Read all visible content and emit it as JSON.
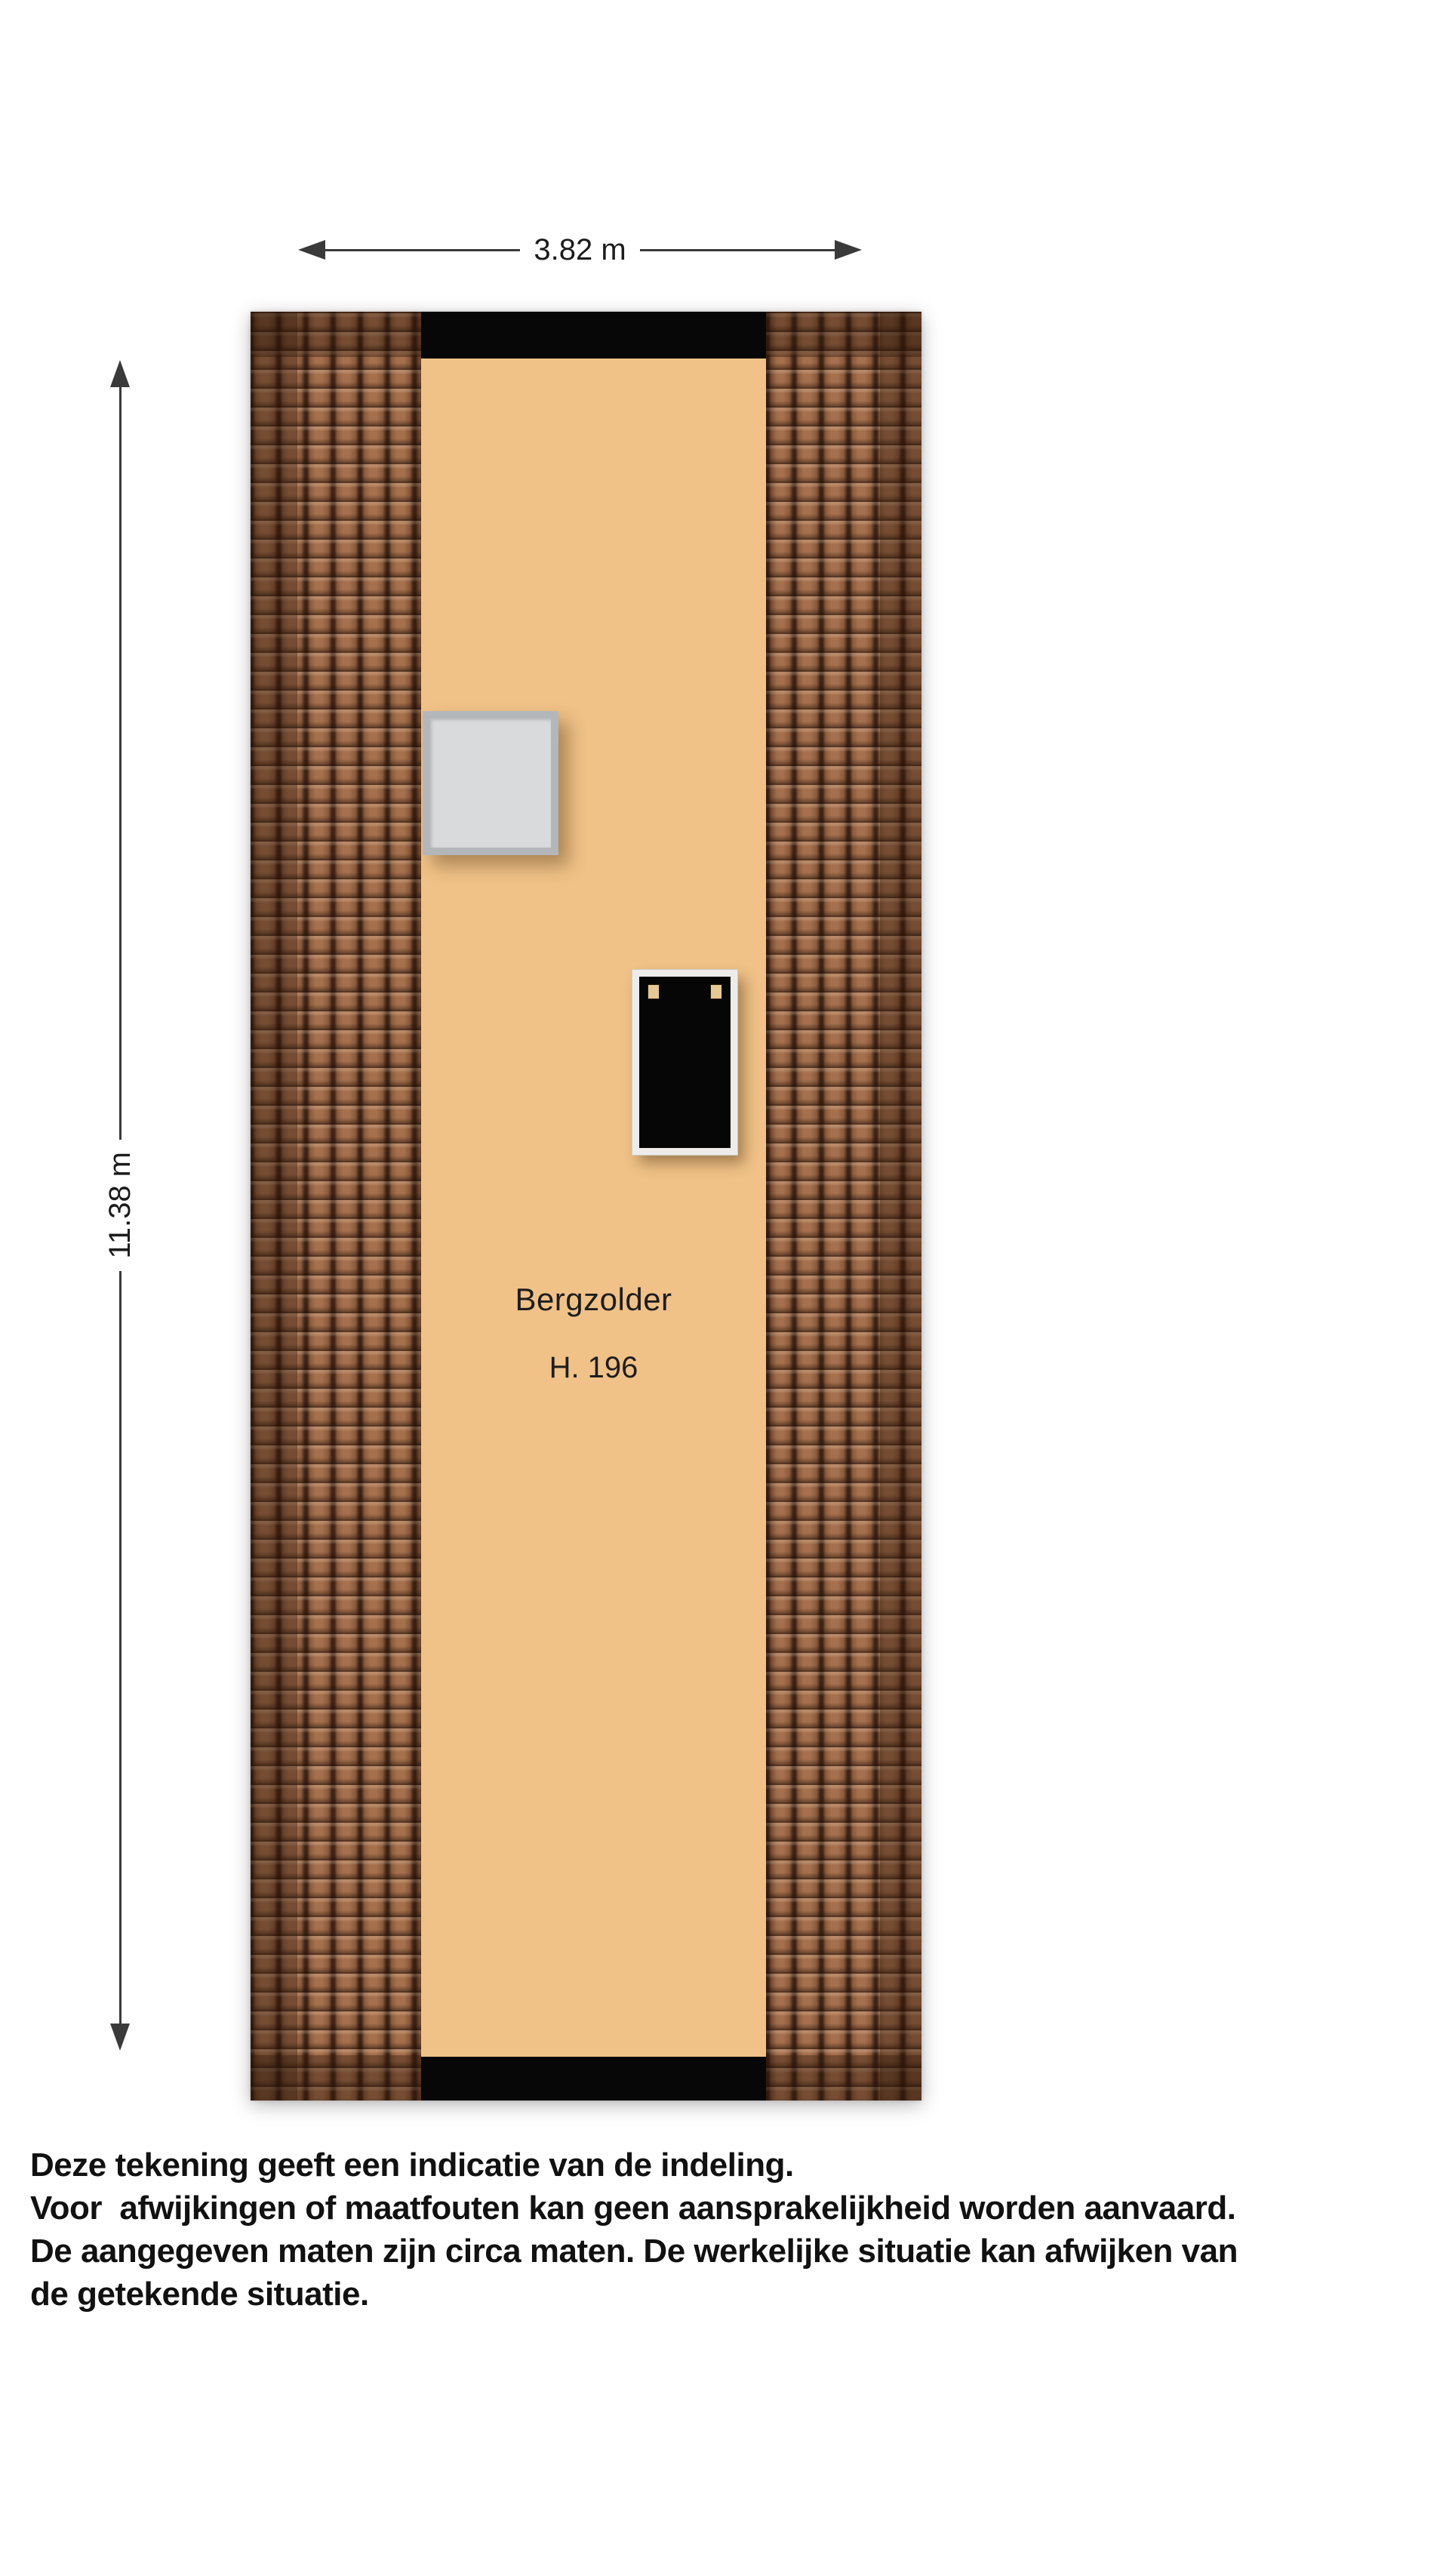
{
  "dimensions": {
    "width_label": "3.82 m",
    "height_label": "11.38 m"
  },
  "room": {
    "name": "Bergzolder",
    "height_label": "H. 196"
  },
  "disclaimer": {
    "lines": [
      "Deze tekening geeft een indicatie van de indeling.",
      "Voor  afwijkingen of maatfouten kan geen aansprakelijkheid worden aanvaard.",
      "De aangegeven maten zijn circa maten. De werkelijke situatie kan afwijken van",
      "de getekende situatie."
    ]
  },
  "colors": {
    "floor": "#f0c287",
    "wall": "#070707",
    "tile_body": "#a5704d",
    "tile_line": "#3d2315",
    "tile_shade": "rgba(43,20,9,0.38)",
    "window_frame": "#b4b7b9",
    "window_glass": "#d9dadb",
    "door_frame": "#edecea",
    "hinge": "#e6c893",
    "dim": "#3a3a3a",
    "text": "#111111"
  }
}
